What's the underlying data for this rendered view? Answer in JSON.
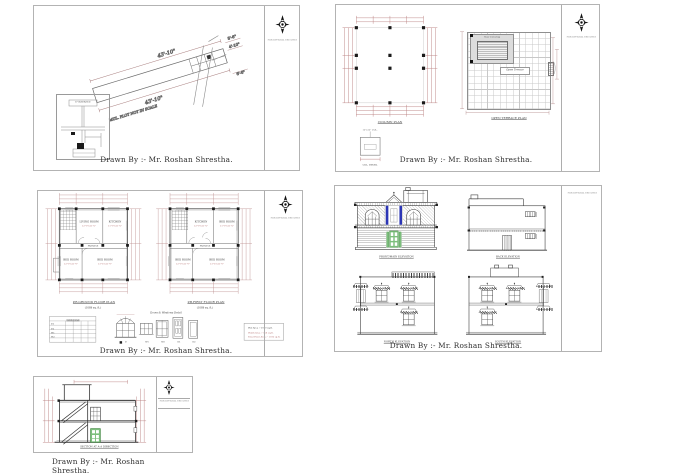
{
  "drawn_by": "Drawn By :- Mr. Roshan Shrestha.",
  "strip_text": "FOR OFFICIAL USE ONLY",
  "colors": {
    "dim": "#b97f7f",
    "accent_blue": "#2b35b5",
    "accent_green": "#7cbf7c"
  },
  "sheet1": {
    "dim_top": "43'-10\"",
    "dim_bottom": "43'-10\"",
    "dim_a": "8'-6\"",
    "dim_b": "4'-10\"",
    "dim_c": "6'-6\"",
    "note": "MUL. PLOT NOT IN SCALE",
    "inset_title": "E-GUIDANCE"
  },
  "sheet2": {
    "column_plan": "COLUMN PLAN",
    "terrace_plan": "OPEN TERRACE PLAN",
    "col_detail": "COL. DETAIL",
    "col_detail_note": "12\"x12\" COL.",
    "open_terrace": "Open Terrace",
    "stair_covering": "Stair Covering"
  },
  "sheet3": {
    "ground": {
      "title": "P.B.GROUND FLOOR PLAN",
      "subtitle": "(1089 sq. ft.)",
      "living": "LIVING ROOM",
      "living_d": "12'-0\"x11'-6\"",
      "kitchen": "KITCHEN",
      "kitchen_d": "11'-0\"x11'-6\"",
      "bed1": "BED ROOM",
      "bed1_d": "12'-0\"x11'-0\"",
      "bed2": "BED ROOM",
      "bed2_d": "13'-6\"x11'-0\"",
      "passage": "PASSAGE"
    },
    "first": {
      "title": "P.B.FIRST FLOOR PLAN",
      "subtitle": "(1089 sq. ft.)",
      "living": "KITCHEN",
      "living_d": "12'-0\"x11'-6\"",
      "kitchen": "BED ROOM",
      "kitchen_d": "11'-0\"x11'-6\"",
      "bed1": "BED ROOM",
      "bed1_d": "12'-0\"x11'-0\"",
      "bed2": "BED ROOM",
      "bed2_d": "13'-6\"x11'-0\"",
      "passage": "PASSAGE"
    },
    "details_heading": "Doors & Windows Detail",
    "tags": [
      "D",
      "W1",
      "W2",
      "D1",
      "D2"
    ],
    "schedule_title": "SCHEDULE",
    "schedule_rows": [
      "D1",
      "D2",
      "W1",
      "W2"
    ],
    "notes": [
      "Plot Area :- 1089 sq.ft.",
      "Plinth Area :- 968 sq.ft.",
      "Total Floor Area :- 1936 sq.ft."
    ]
  },
  "sheet4": {
    "front": "FRONT/MAIN ELEVATION",
    "back": "BACK ELEVATION",
    "north": "NORTH ELEVATION",
    "south": "SOUTH ELEVATION"
  },
  "sheet5": {
    "label": "SECTION AT A-A DIRECTION"
  }
}
